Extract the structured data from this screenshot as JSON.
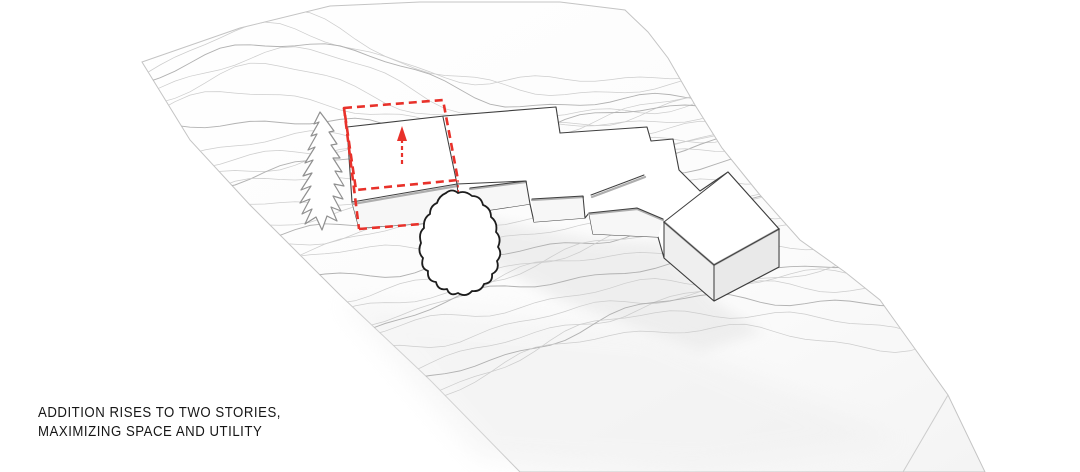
{
  "caption": {
    "line1": "ADDITION RISES TO TWO STORIES,",
    "line2": "MAXIMIZING SPACE AND UTILITY"
  },
  "colors": {
    "accent_red": "#e8312a",
    "building_line": "#3f3f3f",
    "contour_light": "#cdcdcd",
    "contour_bold": "#b2b2b2",
    "background": "#ffffff"
  },
  "scene": {
    "type": "axonometric-site-diagram",
    "elements": [
      "topographic-contour-terrain",
      "existing-house-massing",
      "two-story-addition-outline",
      "extrusion-arrow",
      "conifer-tree",
      "deciduous-tree"
    ]
  }
}
